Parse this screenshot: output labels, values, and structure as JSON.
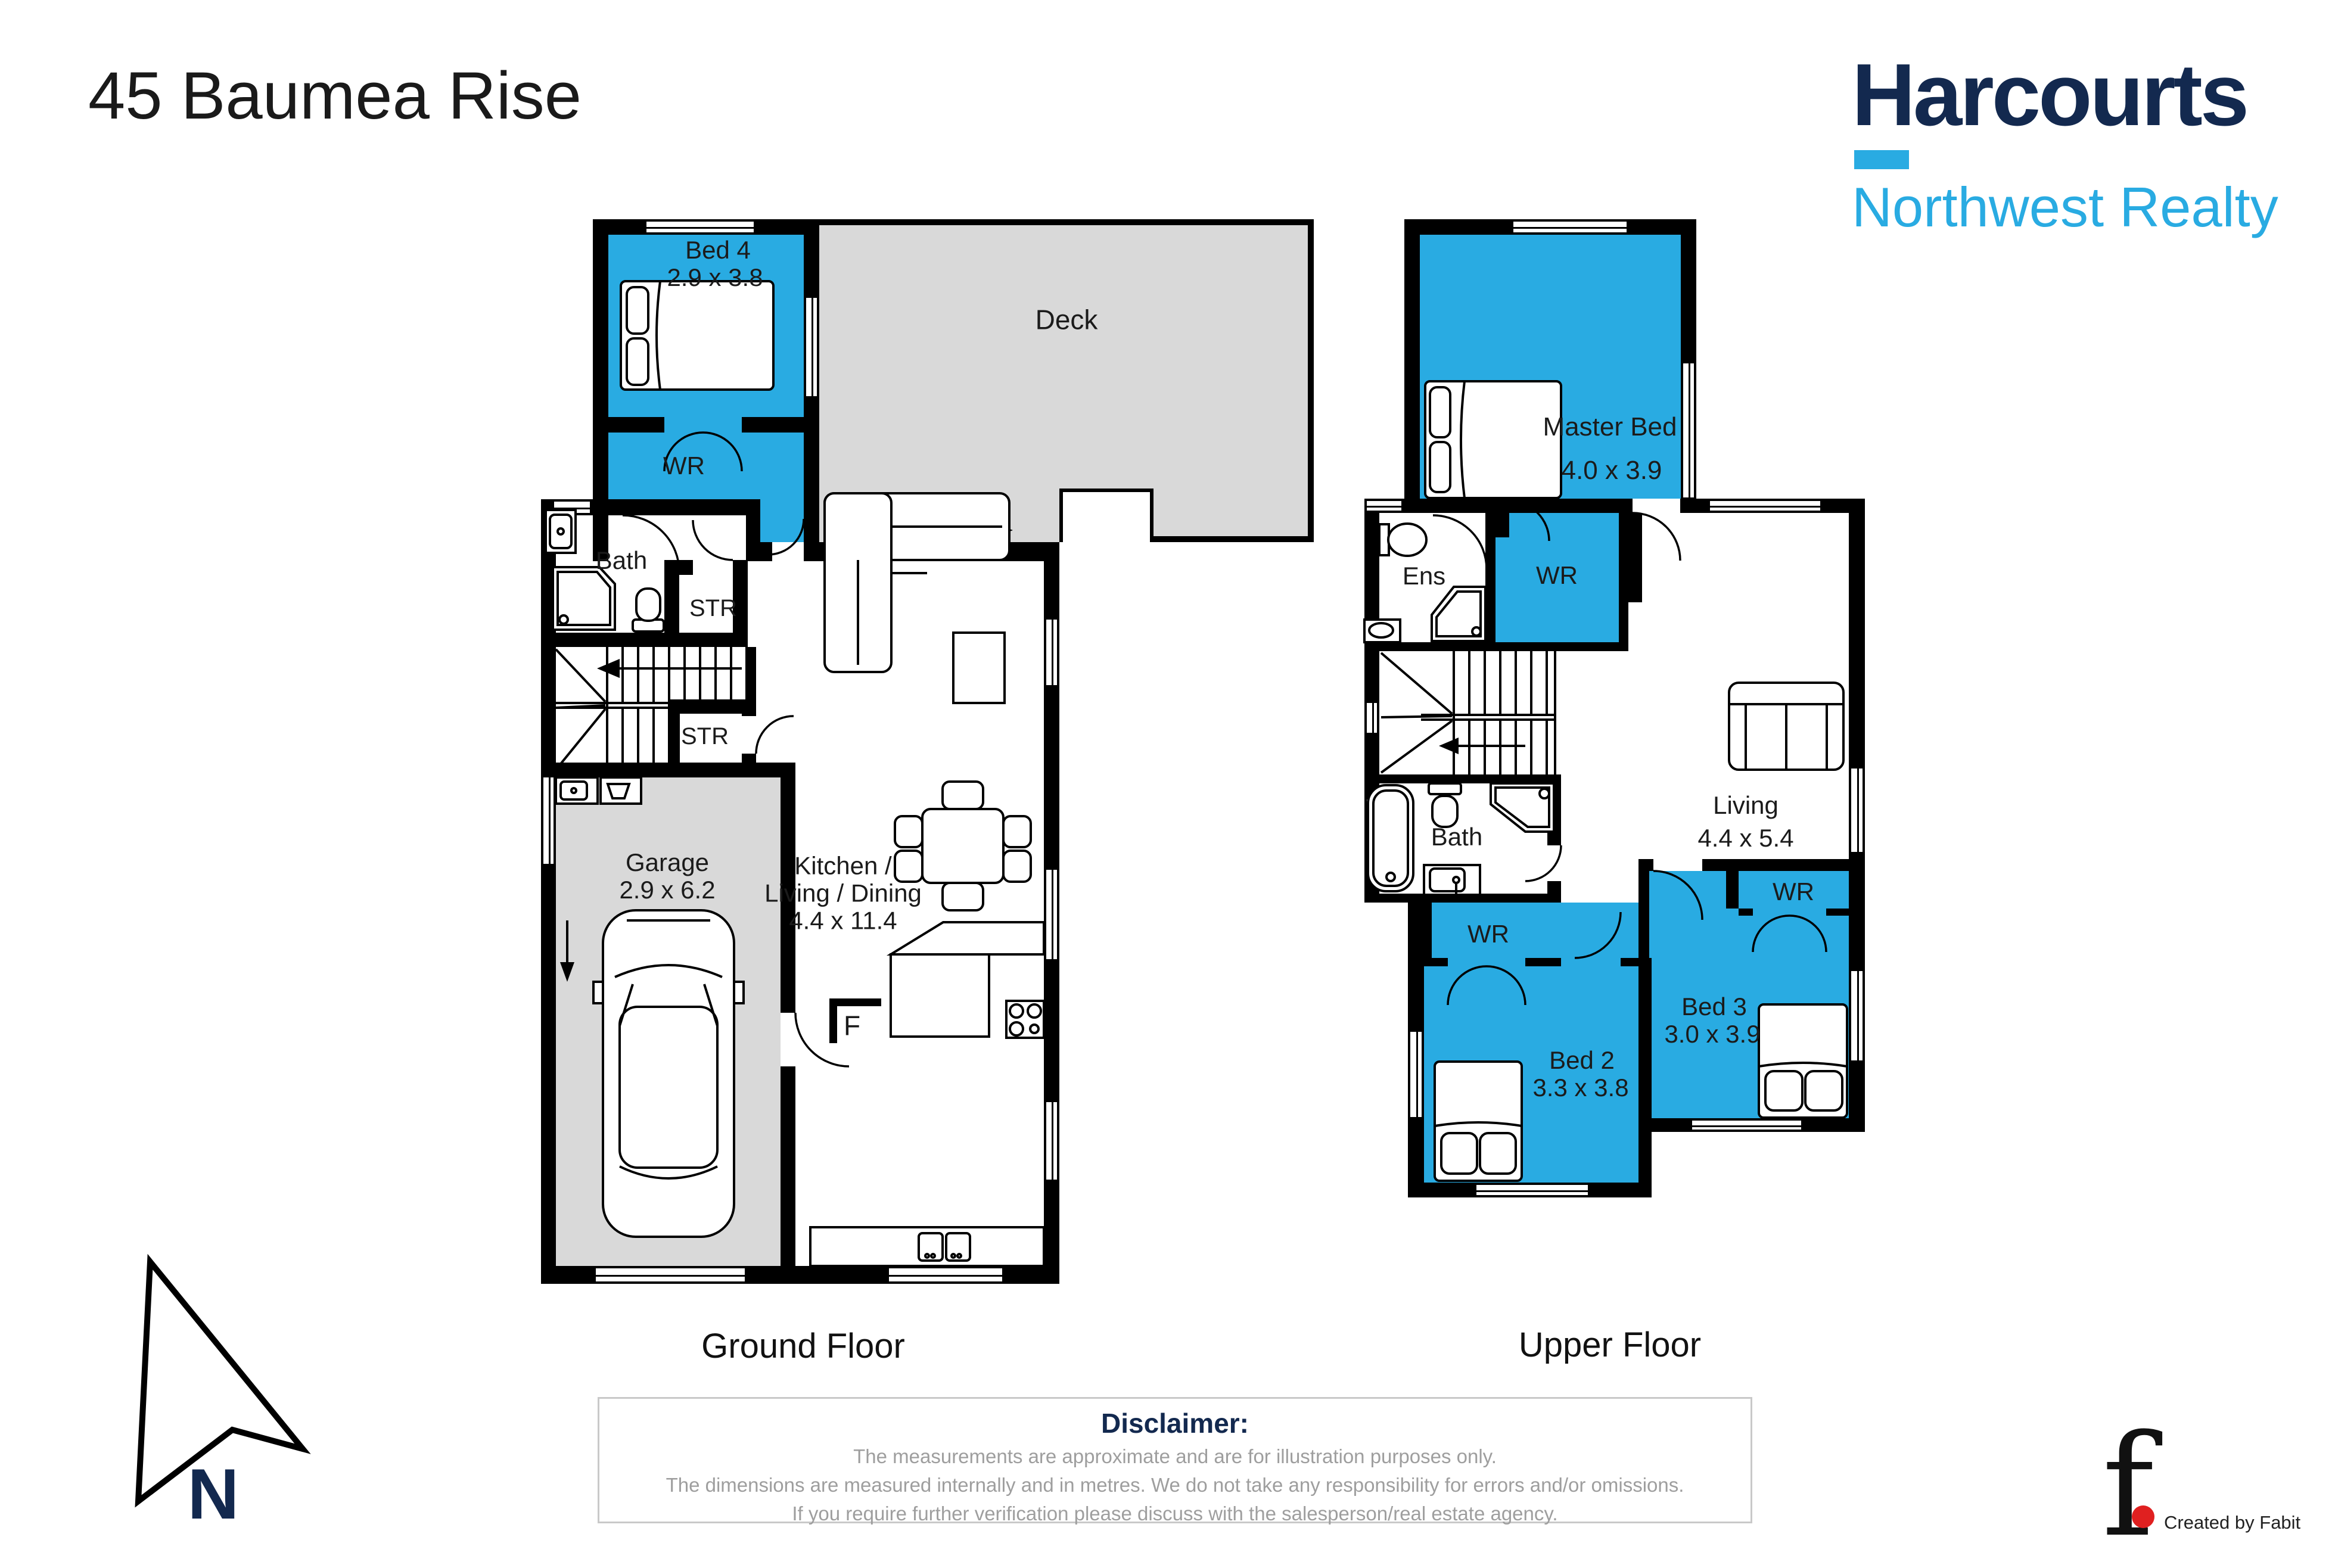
{
  "page": {
    "title": "45 Baumea Rise"
  },
  "brand": {
    "name": "Harcourts",
    "tagline": "Northwest Realty"
  },
  "floors": {
    "ground": {
      "caption": "Ground Floor",
      "rooms": {
        "bed4": {
          "name": "Bed 4",
          "dims": "2.9 x 3.8"
        },
        "bed4_wr": {
          "name": "WR"
        },
        "deck": {
          "name": "Deck"
        },
        "bath": {
          "name": "Bath"
        },
        "str_upper": {
          "name": "STR"
        },
        "str_lower": {
          "name": "STR"
        },
        "garage": {
          "name": "Garage",
          "dims": "2.9 x 6.2"
        },
        "kitchen": {
          "line1": "Kitchen /",
          "line2": "Living / Dining",
          "dims": "4.4 x 11.4"
        },
        "fridge": {
          "name": "F"
        }
      }
    },
    "upper": {
      "caption": "Upper Floor",
      "rooms": {
        "master": {
          "name": "Master Bed",
          "dims": "4.0 x 3.9"
        },
        "ens": {
          "name": "Ens"
        },
        "master_wr": {
          "name": "WR"
        },
        "living": {
          "name": "Living",
          "dims": "4.4 x 5.4"
        },
        "bath": {
          "name": "Bath"
        },
        "bed2_wr": {
          "name": "WR"
        },
        "bed2": {
          "name": "Bed 2",
          "dims": "3.3 x 3.8"
        },
        "bed3": {
          "name": "Bed 3",
          "dims": "3.0 x 3.9"
        },
        "bed3_wr": {
          "name": "WR"
        }
      }
    }
  },
  "compass": {
    "label": "N"
  },
  "disclaimer": {
    "heading": "Disclaimer:",
    "lines": [
      "The measurements are approximate and are for illustration purposes only.",
      "The dimensions are measured internally and in metres. We do not take any responsibility for errors and/or omissions.",
      "If you require further verification please discuss with the salesperson/real estate agency."
    ]
  },
  "credit": {
    "logo_glyph": "f",
    "text": "Created by Fabit"
  },
  "colors": {
    "room_blue": "#29ABE2",
    "area_gray": "#D9D9D9",
    "wall_black": "#000000",
    "brand_navy": "#13294F",
    "brand_blue": "#29ABE2",
    "disclaimer_gray": "#9E9E9E",
    "credit_red": "#E02020"
  }
}
